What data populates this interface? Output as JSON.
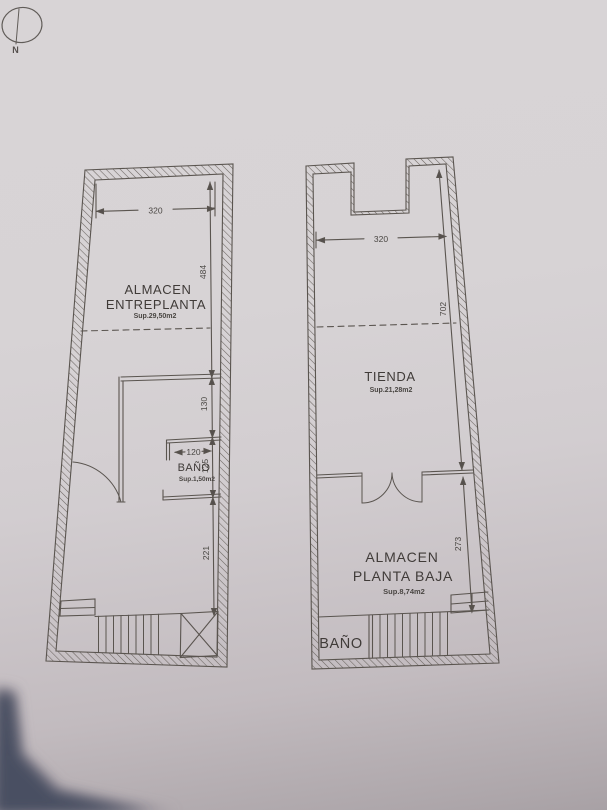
{
  "photo": {
    "paper_top": "#d8d4d6",
    "paper_bottom": "#a8a1a5",
    "ink": "#5a5450",
    "text_ink": "#3f3b39",
    "corner_shadow": "#4a5062"
  },
  "compass": {
    "north_label": "N"
  },
  "left_plan": {
    "width_dim": "320",
    "upper_height_dim": "484",
    "landing_dim": "130",
    "bath_width_dim": "120",
    "bath_height_dim": "125",
    "lower_height_dim": "221",
    "room1_line1": "ALMACEN",
    "room1_line2": "ENTREPLANTA",
    "room1_area": "Sup.29,50m2",
    "bath_label": "BAÑO",
    "bath_area": "Sup.1,50m2"
  },
  "right_plan": {
    "width_dim": "320",
    "shop_depth_dim": "702",
    "storage_depth_dim": "273",
    "shop_label": "TIENDA",
    "shop_area": "Sup.21,28m2",
    "storage_line1": "ALMACEN",
    "storage_line2": "PLANTA BAJA",
    "storage_area": "Sup.8,74m2",
    "bath_label": "BAÑO"
  }
}
